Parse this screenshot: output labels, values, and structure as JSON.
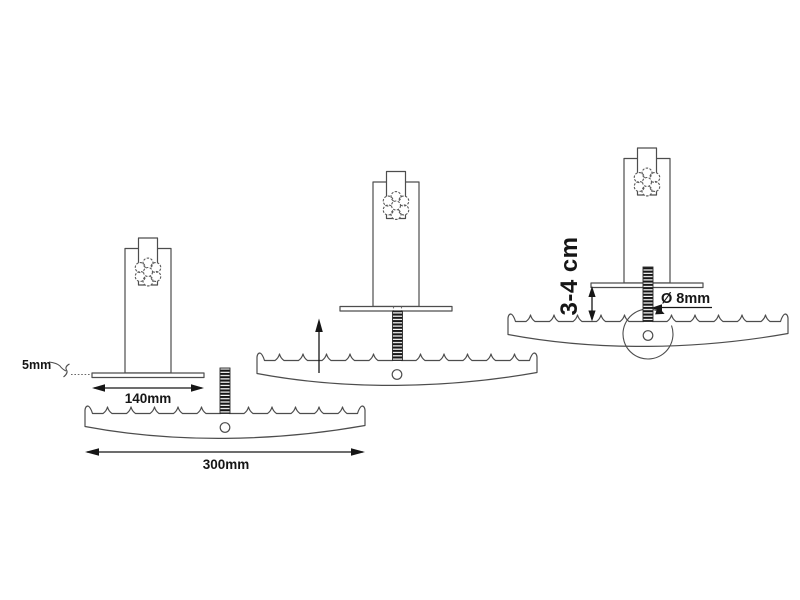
{
  "diagram": {
    "description": "three-step assembly drawing of a serrated blade mounted to a stand with a knob-tightened threaded bolt",
    "labels": {
      "plate_thickness": "5mm",
      "plate_width": "140mm",
      "blade_length": "300mm",
      "mount_gap": "3-4 cm",
      "bolt_diameter": "Ø 8mm"
    },
    "colors": {
      "background": "#ffffff",
      "part_outline": "#4d4d4d",
      "dimension": "#161616",
      "thread_fill": "#161616"
    }
  }
}
